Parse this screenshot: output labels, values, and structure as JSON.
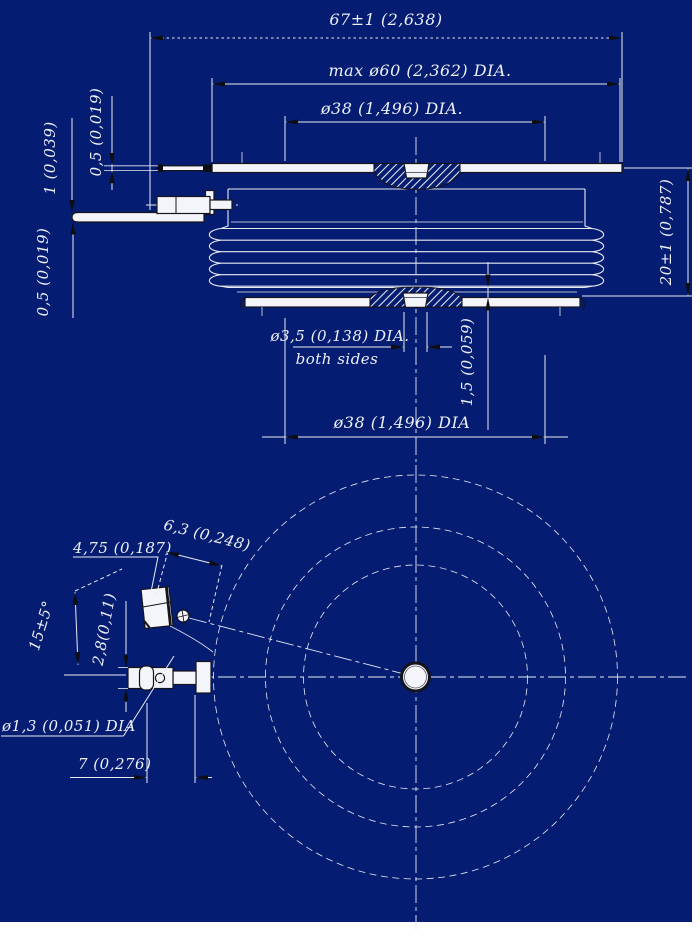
{
  "colors": {
    "background": "#041d72",
    "line": "#e8eaf2",
    "shape_fill": "#f4f5fa",
    "outline": "#14141c",
    "arrow": "#0d0d14",
    "text": "#eef0f6"
  },
  "labels": {
    "total_width": "67±1 (2,638)",
    "max_dia": "max ø60 (2,362) DIA.",
    "pole_dia_top": "ø38 (1,496) DIA.",
    "lead_thk_top": "0,5 (0,019)",
    "lead_thk_mid": "1 (0,039)",
    "lead_thk_bot": "0,5 (0,019)",
    "height": "20±1 (0,787)",
    "gate_hole_dia": "ø3,5 (0,138) DIA.",
    "gate_hole_note": "both sides",
    "boss_height": "1,5 (0,059)",
    "pole_dia_bottom": "ø38 (1,496) DIA",
    "tab_width": "4,75 (0,187)",
    "tab_offset": "6,3 (0,248)",
    "lead_angle": "15±5°",
    "lug_thickness": "2,8(0,11)",
    "wire_hole_dia": "ø1,3 (0,051) DIA",
    "hole_offset": "7 (0,276)"
  }
}
